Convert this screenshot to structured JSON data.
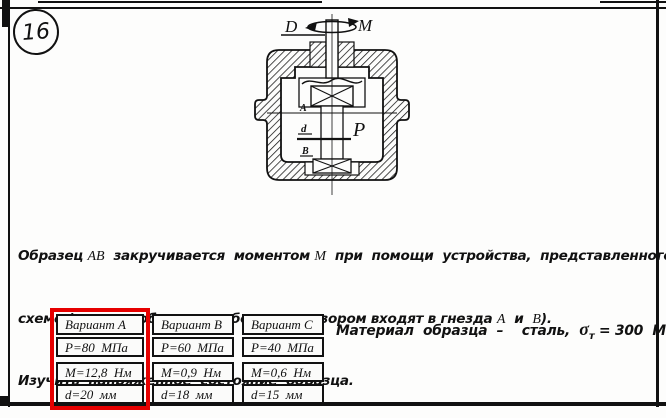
{
  "page": {
    "card_number": "16"
  },
  "figure": {
    "labels": {
      "D": "D",
      "M": "M",
      "A": "A",
      "d": "d",
      "P": "P",
      "B": "B"
    }
  },
  "problem": {
    "line1": {
      "t0": "Образец ",
      "v1": "AB",
      "t2": "  закручивается  моментом ",
      "v3": "M",
      "t4": "  при  помощи  устройства,  представленного  на"
    },
    "line2": {
      "t0": "схеме (головки образца свободно,  с зазором входят в гнезда ",
      "v1": "A",
      "t2": "  и  ",
      "v3": "B",
      "t4": ")."
    },
    "line3": {
      "t0": "Изучить  напряженное  состояние  образца."
    }
  },
  "table": {
    "highlight_color": "#e60000",
    "columns": [
      {
        "variant": "Вариант А",
        "p": "P=80  МПа",
        "m": "M=12,8  Нм",
        "d": "d=20  мм"
      },
      {
        "variant": "Вариант В",
        "p": "P=60  МПа",
        "m": "M=0,9  Нм",
        "d": "d=18  мм"
      },
      {
        "variant": "Вариант С",
        "p": "P=40  МПа",
        "m": "M=0,6  Нм",
        "d": "d=15  мм"
      }
    ]
  },
  "material": {
    "t0": "Материал  образца  –    сталь,  ",
    "sigma": "σ",
    "sub": "т",
    "t1": " = 300  МПа"
  }
}
